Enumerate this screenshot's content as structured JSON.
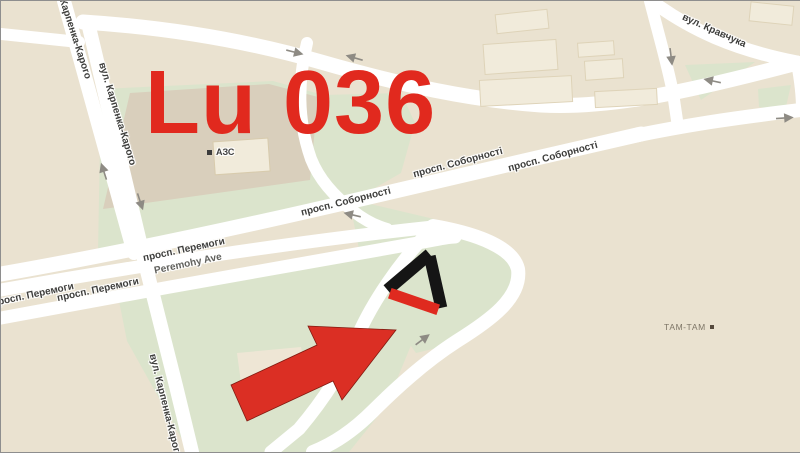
{
  "overlay": {
    "label": "Lu 036"
  },
  "streets": {
    "karpenka_short": "Карпенка-Карого",
    "karpenka": "вул. Карпенка-Карого",
    "peremohy": "просп. Перемоги",
    "peremohy_latin": "Peremohy Ave",
    "sobornosti": "просп. Соборності",
    "kravchuka": "вул. Кравчука"
  },
  "pois": {
    "gas_station": "АЗС",
    "mall": "ТАМ-ТАМ"
  },
  "colors": {
    "background": "#eae2d0",
    "road": "#ffffff",
    "green_area": "#dbe4cc",
    "block_tan": "#d9cfbc",
    "building": "#f1ebdb",
    "overlay_red": "#e1291e",
    "arrow_red": "#db2f24",
    "marker_black": "#151515",
    "marker_red": "#df2a1f",
    "direction_arrow_gray": "#8e8b84"
  }
}
